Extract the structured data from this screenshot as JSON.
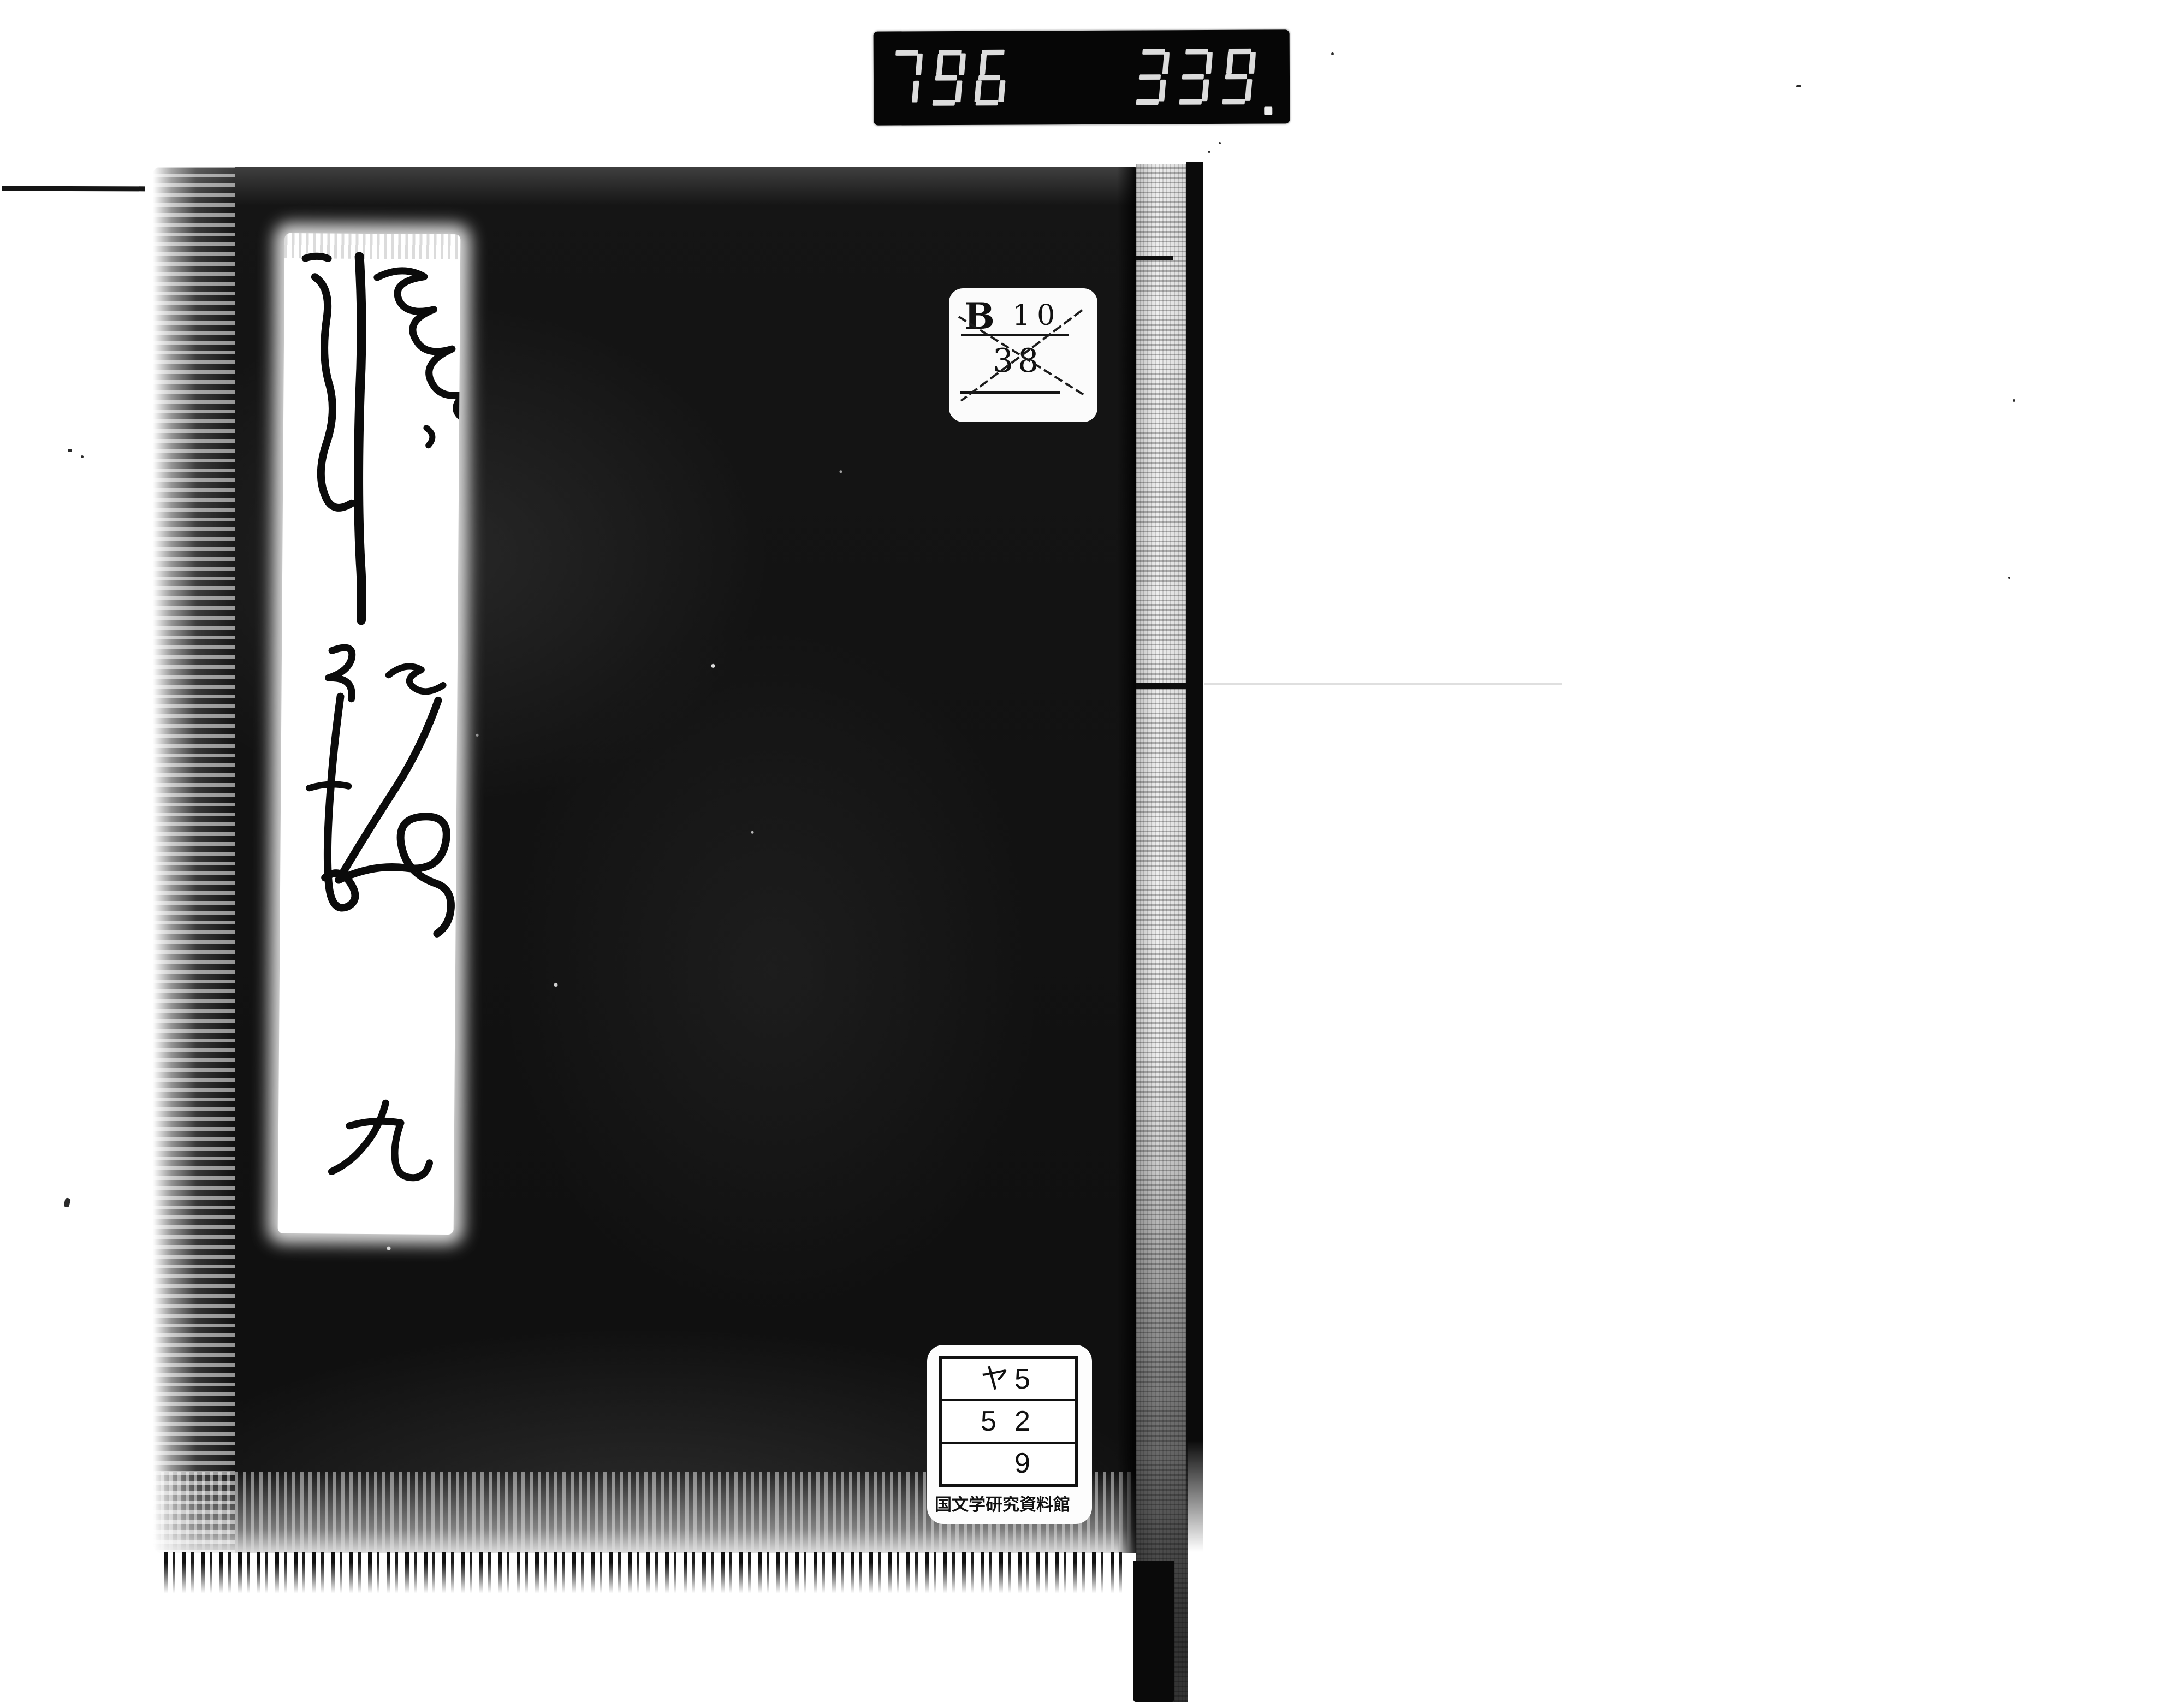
{
  "page": {
    "background": "#ffffff"
  },
  "counter": {
    "groups": [
      "796",
      "339."
    ],
    "digit_color": "#ededed",
    "background": "#060606"
  },
  "book": {
    "title": "姫鏡",
    "title_characters": [
      "姫",
      "鏡"
    ],
    "volume": "九",
    "cover_color": "#121212"
  },
  "labels": {
    "classification": {
      "letter": "B",
      "number": "10",
      "lower": "38",
      "crossed_out": true
    },
    "call_number": {
      "rows": [
        [
          "ヤ",
          "5"
        ],
        [
          "5",
          "2"
        ],
        [
          "",
          "9"
        ]
      ],
      "institution": "国文学研究資料館"
    }
  }
}
